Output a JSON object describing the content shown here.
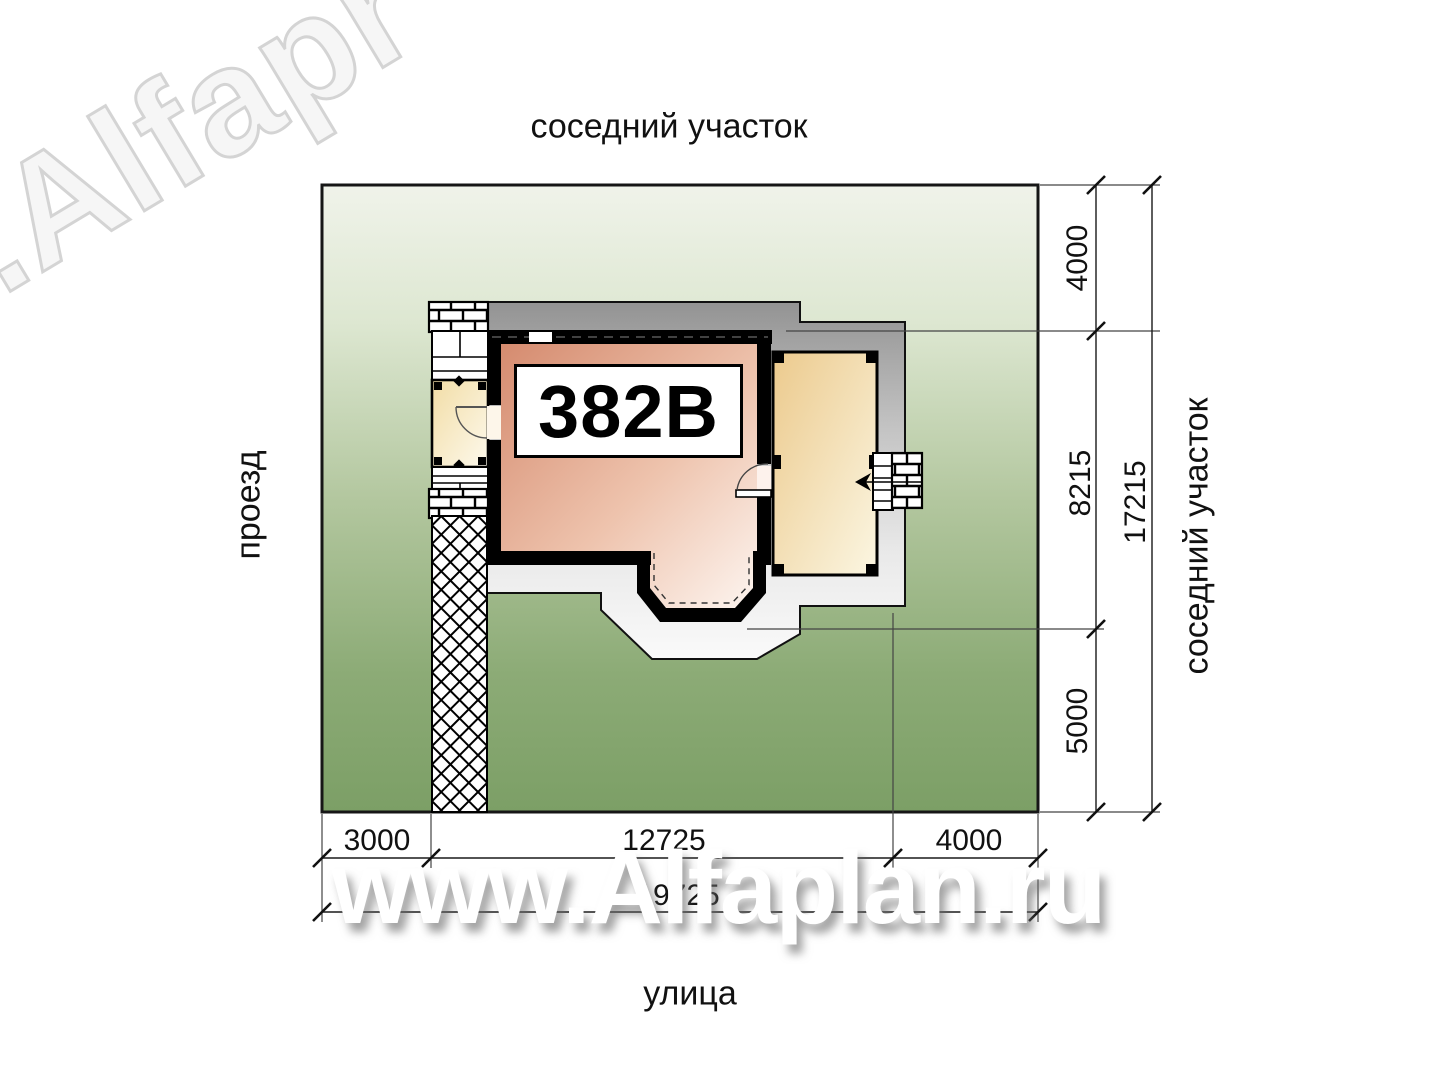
{
  "surroundings": {
    "top_label": "соседний участок",
    "right_label": "соседний участок",
    "left_label": "проезд",
    "bottom_label": "улица"
  },
  "house": {
    "plan_number": "382В"
  },
  "dimensions": {
    "vertical": {
      "segments": [
        "4000",
        "8215",
        "5000"
      ],
      "total": "17215"
    },
    "horizontal": {
      "segments": [
        "3000",
        "12725",
        "4000"
      ],
      "total": "19725"
    }
  },
  "watermarks": {
    "diagonal": ".Alfapr",
    "site": "www.Alfaplan.ru"
  },
  "colors": {
    "plot_green_top": "#eef2e7",
    "plot_green_bottom": "#7c9f66",
    "room_fill": "#d78f74",
    "terrace_fill": "#ecc98e",
    "roof_band_dark": "#979797",
    "roof_band_light": "#f6f6f6",
    "wall": "#000000"
  }
}
